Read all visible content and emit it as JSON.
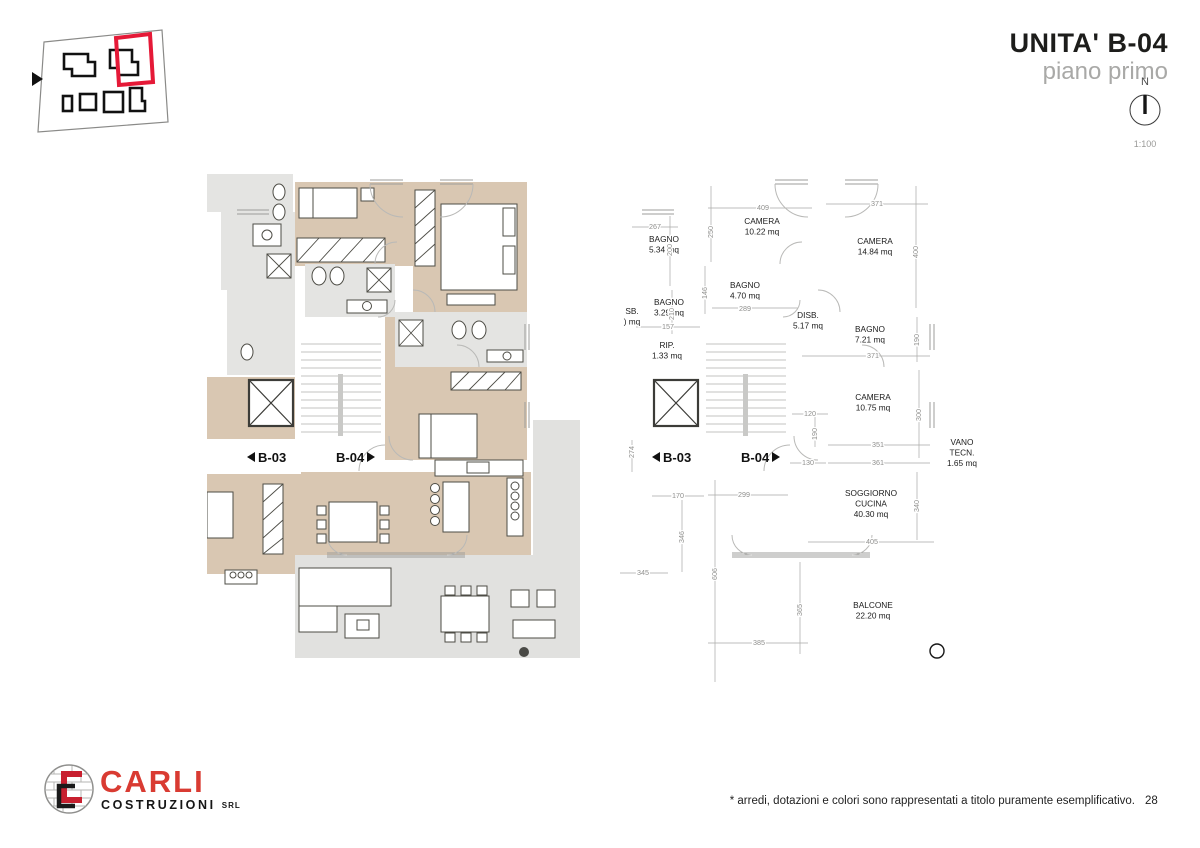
{
  "header": {
    "title": "UNITA' B-04",
    "subtitle": "piano primo",
    "north_label": "N",
    "scale_label": "1:100"
  },
  "landing": {
    "left_unit": "B-03",
    "right_unit": "B-04"
  },
  "tech_plan": {
    "room_labels": [
      {
        "x": 150,
        "y": 62,
        "lines": [
          "CAMERA",
          "10.22 mq"
        ]
      },
      {
        "x": 263,
        "y": 82,
        "lines": [
          "CAMERA",
          "14.84 mq"
        ]
      },
      {
        "x": 52,
        "y": 80,
        "lines": [
          "BAGNO",
          "5.34 mq"
        ]
      },
      {
        "x": 133,
        "y": 126,
        "lines": [
          "BAGNO",
          "4.70 mq"
        ]
      },
      {
        "x": 57,
        "y": 143,
        "lines": [
          "BAGNO",
          "3.29 mq"
        ]
      },
      {
        "x": 55,
        "y": 186,
        "lines": [
          "RIP.",
          "1.33 mq"
        ]
      },
      {
        "x": 196,
        "y": 156,
        "lines": [
          "DISB.",
          "5.17 mq"
        ]
      },
      {
        "x": 258,
        "y": 170,
        "lines": [
          "BAGNO",
          "7.21 mq"
        ]
      },
      {
        "x": 261,
        "y": 238,
        "lines": [
          "CAMERA",
          "10.75 mq"
        ]
      },
      {
        "x": 350,
        "y": 283,
        "lines": [
          "VANO",
          "TECN.",
          "1.65 mq"
        ]
      },
      {
        "x": 259,
        "y": 334,
        "lines": [
          "SOGGIORNO",
          "CUCINA",
          "40.30 mq"
        ]
      },
      {
        "x": 261,
        "y": 446,
        "lines": [
          "BALCONE",
          "22.20 mq"
        ]
      },
      {
        "x": 20,
        "y": 152,
        "lines": [
          "SB.",
          ") mq"
        ]
      }
    ],
    "dim_labels": [
      {
        "t": "409",
        "x": 151,
        "y": 48
      },
      {
        "t": "371",
        "x": 265,
        "y": 44
      },
      {
        "t": "267",
        "x": 43,
        "y": 67
      },
      {
        "t": "250",
        "x": 101,
        "y": 70,
        "r": true
      },
      {
        "t": "200",
        "x": 60,
        "y": 88,
        "r": true
      },
      {
        "t": "400",
        "x": 306,
        "y": 90,
        "r": true
      },
      {
        "t": "146",
        "x": 95,
        "y": 131,
        "r": true
      },
      {
        "t": "210",
        "x": 62,
        "y": 152,
        "r": true
      },
      {
        "t": "289",
        "x": 133,
        "y": 149
      },
      {
        "t": "157",
        "x": 56,
        "y": 167
      },
      {
        "t": "371",
        "x": 261,
        "y": 196
      },
      {
        "t": "190",
        "x": 307,
        "y": 178,
        "r": true
      },
      {
        "t": "120",
        "x": 198,
        "y": 254
      },
      {
        "t": "190",
        "x": 205,
        "y": 272,
        "r": true
      },
      {
        "t": "300",
        "x": 309,
        "y": 253,
        "r": true
      },
      {
        "t": "351",
        "x": 266,
        "y": 285
      },
      {
        "t": "361",
        "x": 266,
        "y": 303
      },
      {
        "t": "130",
        "x": 196,
        "y": 303
      },
      {
        "t": "274",
        "x": 22,
        "y": 290,
        "r": true
      },
      {
        "t": "170",
        "x": 66,
        "y": 336
      },
      {
        "t": "299",
        "x": 132,
        "y": 335
      },
      {
        "t": "346",
        "x": 72,
        "y": 375,
        "r": true
      },
      {
        "t": "345",
        "x": 31,
        "y": 413
      },
      {
        "t": "606",
        "x": 105,
        "y": 412,
        "r": true
      },
      {
        "t": "340",
        "x": 307,
        "y": 344,
        "r": true
      },
      {
        "t": "405",
        "x": 260,
        "y": 382
      },
      {
        "t": "365",
        "x": 190,
        "y": 448,
        "r": true
      },
      {
        "t": "385",
        "x": 147,
        "y": 483
      }
    ]
  },
  "footer": {
    "logo_text": "CARLI",
    "logo_sub": "COSTRUZIONI",
    "logo_suffix": "SRL",
    "disclaimer": "* arredi, dotazioni e colori sono rappresentati a titolo puramente esemplificativo.",
    "page_number": "28"
  },
  "colors": {
    "accent_red": "#e51937",
    "logo_red": "#d93b32",
    "wall_dark": "#56554d",
    "wall_black": "#161616",
    "floor_beige": "#d9c7b2",
    "floor_gray": "#e4e4e2",
    "dim_gray": "#8f8f8d"
  }
}
